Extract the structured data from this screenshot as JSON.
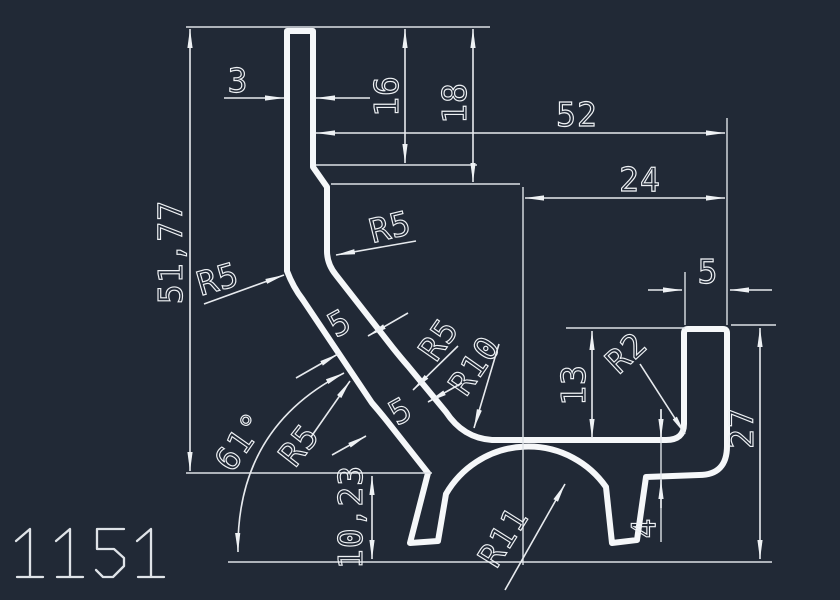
{
  "drawing": {
    "part_number": "1151",
    "background_color": "#212936",
    "line_color": "#f5f7f9",
    "dimensions": {
      "width_top_strip": "3",
      "height_16": "16",
      "height_18": "18",
      "width_52": "52",
      "width_24": "24",
      "wall_width_5": "5",
      "height_13": "13",
      "height_27": "27",
      "plate_thickness_4": "4",
      "height_51_77": "51,77",
      "height_10_23": "10,23",
      "thickness_upper_5": "5",
      "thickness_lower_5": "5",
      "radius_r5_top": "R5",
      "radius_r5_left": "R5",
      "radius_r5_mid": "R5",
      "radius_r5_bottom": "R5",
      "radius_r10": "R10",
      "radius_r11": "R11",
      "radius_r2": "R2",
      "angle_61": "61°"
    }
  }
}
